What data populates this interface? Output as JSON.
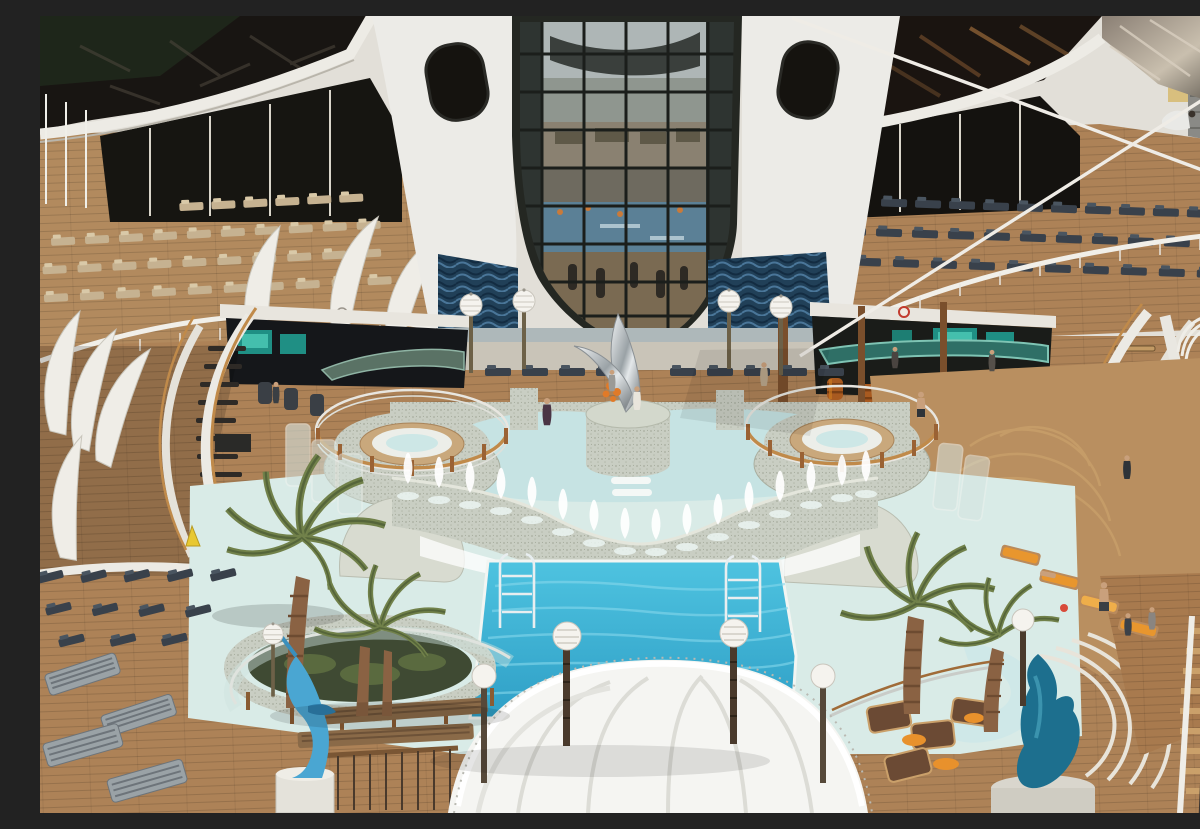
{
  "meta": {
    "domain": "Natural-Image",
    "title": "Aerial view of a cruise ship lido pool deck",
    "aria_label": "Aerial photograph of a cruise ship pool deck on a sunny day: a mirrored glass atrium at top center, white curved superstructure with tinted glass bands, rows of sun loungers, two raised mosaic hot tubs with wooden-post railings, a pale upper wading pool, a stone fountain wall with white water jets, a turquoise main swimming pool with two chrome ladders, globe lamp posts, palm trees, a white tensile canopy at bottom, a blue marlin sculpture and a teal dolphin sculpture, curved staircases on both sides, pool bars with teal screens and barrel stools, and diagonal white rigging cables with a port building visible top right."
  },
  "scene": {
    "setting": "cruise ship top deck, docked in port, bright sunlight",
    "elements": [
      "glass atrium with mirrored reflection panels",
      "white superstructure with dark tinted glass bands",
      "rows of sun loungers on teak decks",
      "two raised mosaic jacuzzis with circular railings",
      "upper shallow pool with stepping cascade",
      "fountain wall with white water jets",
      "main turquoise swimming pool with two ladders",
      "globe lamp posts",
      "palm trees in stone planters",
      "white tensile fabric canopy",
      "blue marlin sculpture on pedestal",
      "teal dolphin sculpture on pedestal",
      "curved port and starboard staircases",
      "pool bars with teal glowing screens and barrel stools",
      "chrome abstract sculpture on mosaic pedestal",
      "diagonal white rigging cables",
      "yellow port building on shore at top right",
      "wet-floor warning cone",
      "sunbathers on orange loungers"
    ],
    "people_count_estimate": 14
  },
  "palette": {
    "pool_deep": "#35b2d8",
    "pool_shallow": "#c6e3e3",
    "wet_deck": "#d9ebe7",
    "wood_deck": "#b28a5e",
    "structure_white": "#ecebe7",
    "glass_dark": "#181512",
    "mosaic_stone": "#c9cec3",
    "wave_tile_blue": "#1d3850",
    "palm_green": "#71814a",
    "accent_orange": "#e8912c",
    "sculpture_blue": "#4aa6d2",
    "sculpture_teal": "#1d6f8e",
    "teal_screen": "#2fa393"
  }
}
